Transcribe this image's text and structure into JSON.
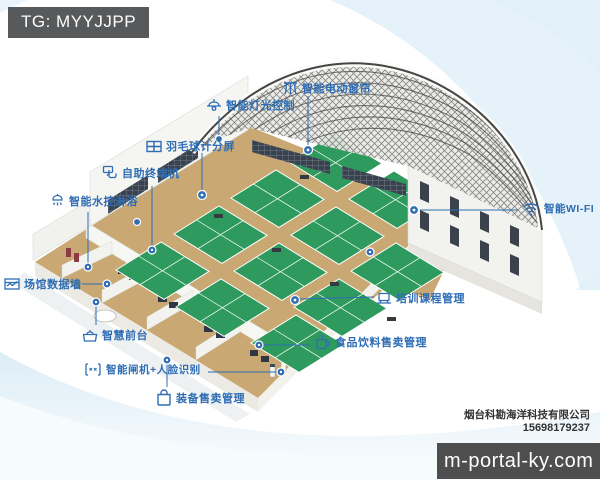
{
  "badge": {
    "text": "TG: MYYJJPP"
  },
  "callouts": [
    {
      "id": "curtain",
      "icon": "curtain-icon",
      "label": "智能电动窗帘"
    },
    {
      "id": "light",
      "icon": "light-icon",
      "label": "智能灯光控制"
    },
    {
      "id": "scoreboard",
      "icon": "scoreboard-icon",
      "label": "羽毛球计分屏"
    },
    {
      "id": "terminal",
      "icon": "touch-icon",
      "label": "自助终端机"
    },
    {
      "id": "shower",
      "icon": "shower-icon",
      "label": "智能水控淋浴"
    },
    {
      "id": "wifi",
      "icon": "wifi-icon",
      "label": "智能WI-FI"
    },
    {
      "id": "datawall",
      "icon": "datawall-icon",
      "label": "场馆数据墙"
    },
    {
      "id": "training",
      "icon": "laptop-icon",
      "label": "培训课程管理"
    },
    {
      "id": "frontdesk",
      "icon": "desk-icon",
      "label": "智慧前台"
    },
    {
      "id": "food",
      "icon": "cup-icon",
      "label": "食品饮料售卖管理"
    },
    {
      "id": "gate",
      "icon": "gate-icon",
      "label": "智能闸机+人脸识别"
    },
    {
      "id": "bag",
      "icon": "bag-icon",
      "label": "装备售卖管理"
    }
  ],
  "footer": {
    "company": "烟台科勘海洋科技有限公司",
    "phone": "15698179237",
    "watermark": "m-portal-ky.com"
  },
  "colors": {
    "label_blue": "#2e6db4",
    "court_green": "#2f9a5d",
    "floor_tan": "#c9a873",
    "badge_bg": "#58595b",
    "watermark_bg": "#4e4e4e",
    "truss_gray": "#4d4d4d",
    "swoosh_blue": "#e4f1f8"
  }
}
